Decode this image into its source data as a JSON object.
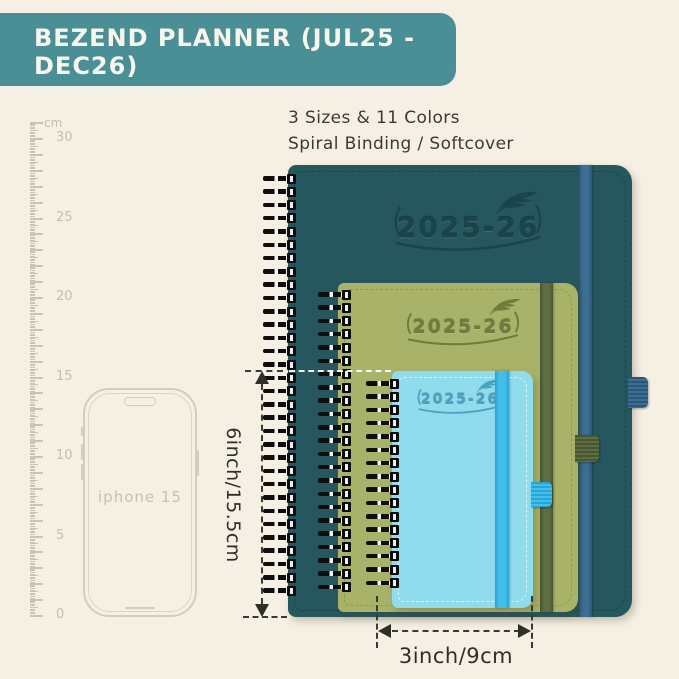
{
  "background": "#f5f0e3",
  "header": {
    "title": "BEZEND PLANNER (JUL25 - DEC26)",
    "subtitle": "Perfect for All Scenarios",
    "bg": "#4a8e96"
  },
  "intro": {
    "line1": "3 Sizes & 11 Colors",
    "line2": "Spiral Binding / Softcover"
  },
  "ruler": {
    "unit": "cm",
    "labels": [
      30,
      25,
      20,
      15,
      10,
      5,
      0
    ]
  },
  "phone": {
    "label": "iphone 15"
  },
  "planners": [
    {
      "size": "large",
      "year": "2025-26",
      "cover": "#27575e",
      "band": "#3c6f94",
      "band_dark": "#2a567a",
      "emboss": "#1a444c",
      "stitch": "#12424a"
    },
    {
      "size": "medium",
      "year": "2025-26",
      "cover": "#a8b369",
      "band": "#5d6e43",
      "band_dark": "#48572f",
      "emboss": "#6f7c3b",
      "stitch": "#8a9748"
    },
    {
      "size": "small",
      "year": "2025-26",
      "cover": "#90dbec",
      "band": "#43bfe9",
      "band_dark": "#27a5d6",
      "emboss": "#47a3c2",
      "stitch": "#eafafd"
    }
  ],
  "dimensions": {
    "height_label": "6inch/15.5cm",
    "width_label": "3inch/9cm"
  }
}
